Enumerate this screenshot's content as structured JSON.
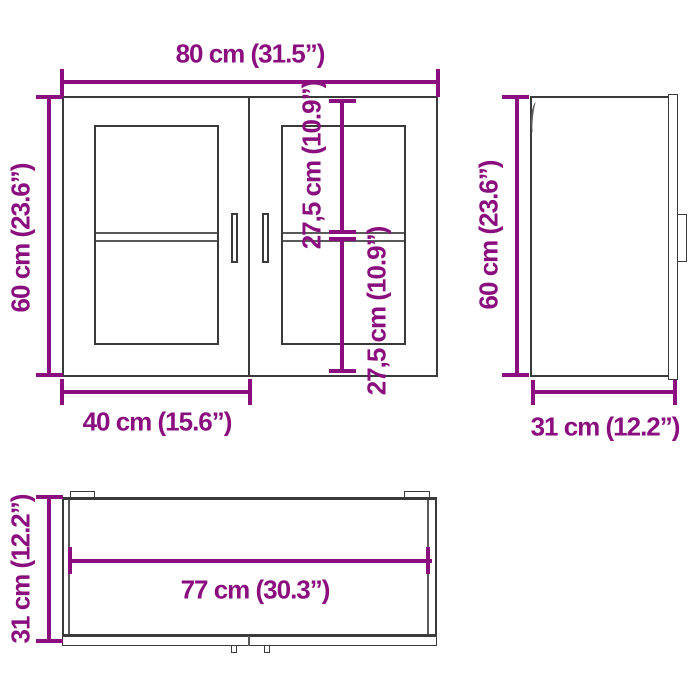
{
  "title": "Wall cabinet dimension diagram",
  "colors": {
    "accent": "#8A0E7E",
    "outline": "#3A3A3A",
    "thin_line": "#5A5A5A",
    "background": "#FFFFFF"
  },
  "views": {
    "front": {
      "width_label": "80 cm (31.5”)",
      "height_label": "60 cm (23.6”)",
      "door_width_label": "40 cm (15.6”)",
      "upper_section_label": "27,5 cm (10.9”)",
      "lower_section_label": "27,5 cm (10.9”)"
    },
    "side": {
      "height_label": "60 cm (23.6”)",
      "depth_label": "31 cm (12.2”)"
    },
    "bottom": {
      "depth_label": "31 cm (12.2”)",
      "inner_width_label": "77 cm (30.3”)"
    }
  }
}
